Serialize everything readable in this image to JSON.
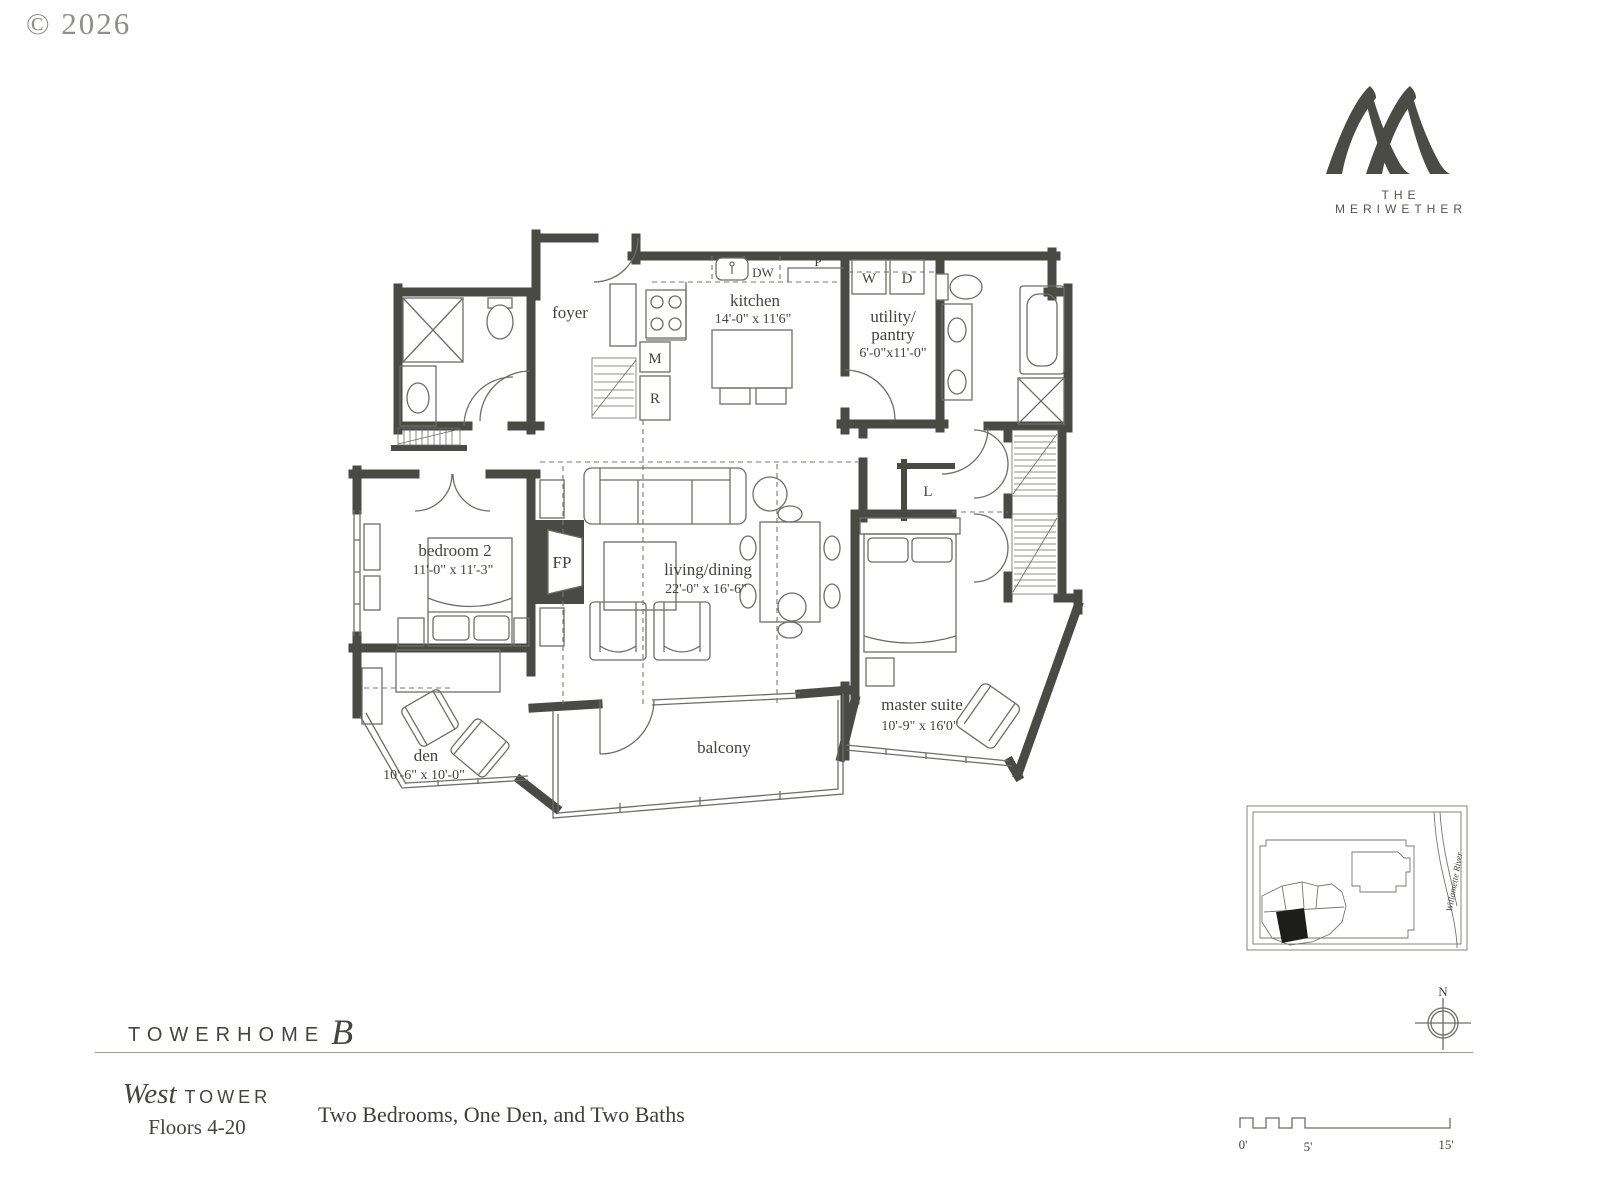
{
  "copyright": "© 2026",
  "brand": {
    "monogram": "meriwether-double-m-monogram",
    "name": "THE MERIWETHER"
  },
  "plan": {
    "rooms": {
      "foyer": {
        "name": "foyer"
      },
      "kitchen": {
        "name": "kitchen",
        "dims": "14'-0\" x 11'6\""
      },
      "utility_pantry": {
        "name_line1": "utility/",
        "name_line2": "pantry",
        "dims": "6'-0\"x11'-0\""
      },
      "bedroom2": {
        "name": "bedroom 2",
        "dims": "11'-0\" x 11'-3\""
      },
      "living_dining": {
        "name": "living/dining",
        "dims": "22'-0\" x 16'-6\""
      },
      "master_suite": {
        "name": "master suite",
        "dims": "10'-9\" x 16'0\""
      },
      "den": {
        "name": "den",
        "dims": "10'-6\" x 10'-0\""
      },
      "balcony": {
        "name": "balcony"
      }
    },
    "labels": {
      "washer": "W",
      "dryer": "D",
      "dishwasher": "DW",
      "pantry": "P",
      "microwave": "M",
      "refrigerator": "R",
      "fireplace": "FP",
      "linen": "L"
    }
  },
  "site_map": {
    "river": "Willamette River"
  },
  "compass": {
    "north": "N"
  },
  "scale_bar": {
    "zero": "0'",
    "five": "5'",
    "fifteen": "15'"
  },
  "footer": {
    "towerhome": "TOWERHOME",
    "towerhome_letter": "B",
    "tower_name": "West",
    "tower_word": "TOWER",
    "floors": "Floors 4-20",
    "summary": "Two Bedrooms, One Den, and Two Baths"
  },
  "colors": {
    "wall": "#4a4a44",
    "line": "#6e6e66",
    "text": "#44443e",
    "muted": "#8f8f89"
  }
}
